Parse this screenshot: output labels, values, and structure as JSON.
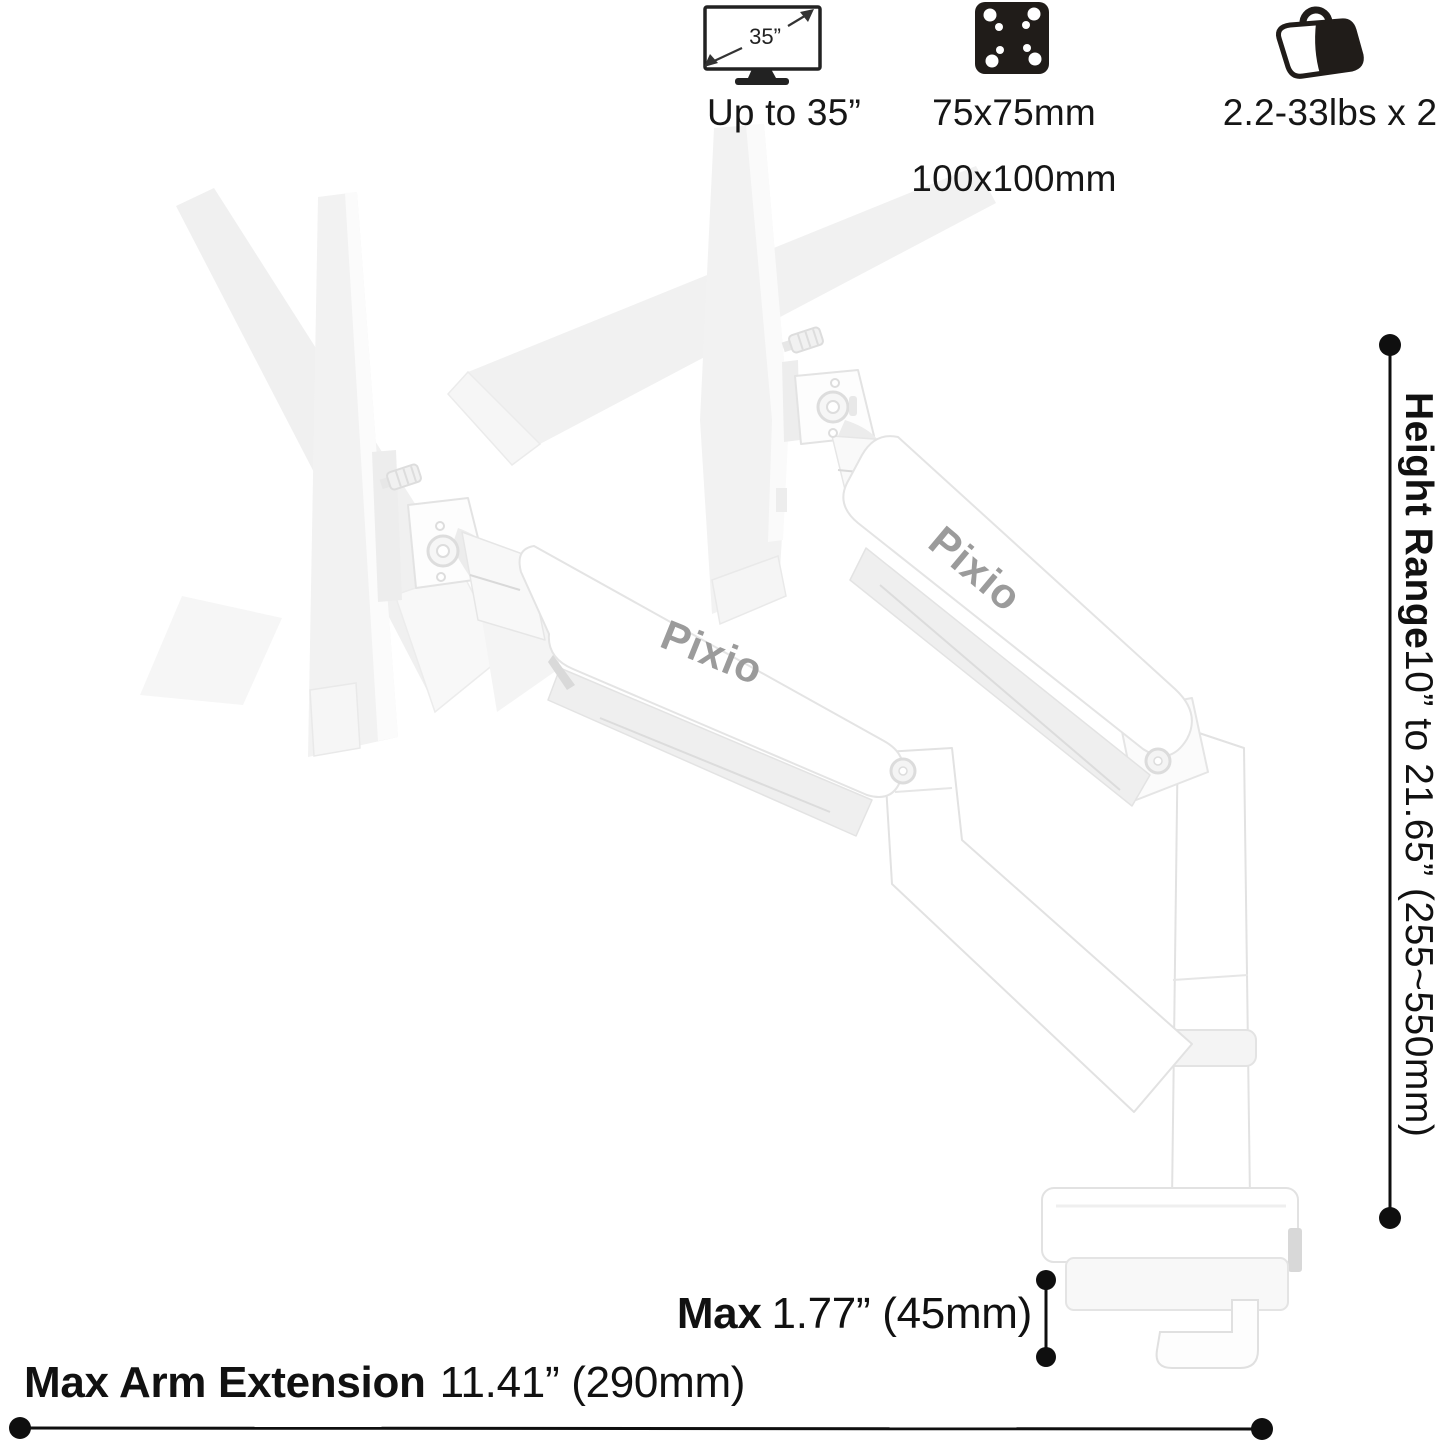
{
  "specs": {
    "screen": {
      "icon_label": "35”",
      "label": "Up to 35”"
    },
    "vesa": {
      "line1": "75x75mm",
      "line2": "100x100mm"
    },
    "weight": {
      "label": "2.2-33lbs x 2"
    }
  },
  "dimensions": {
    "height_range": {
      "name": "Height Range",
      "value": "10” to 21.65” (255~550mm)"
    },
    "desk_thickness": {
      "name": "Max",
      "value": "1.77” (45mm)"
    },
    "arm_extension": {
      "name": "Max Arm Extension",
      "value": "11.41” (290mm)"
    }
  },
  "product": {
    "brand": "Pixio"
  },
  "colors": {
    "annotation": "#111111",
    "brand_text": "#9b9b9b",
    "icon_black": "#201c19"
  }
}
